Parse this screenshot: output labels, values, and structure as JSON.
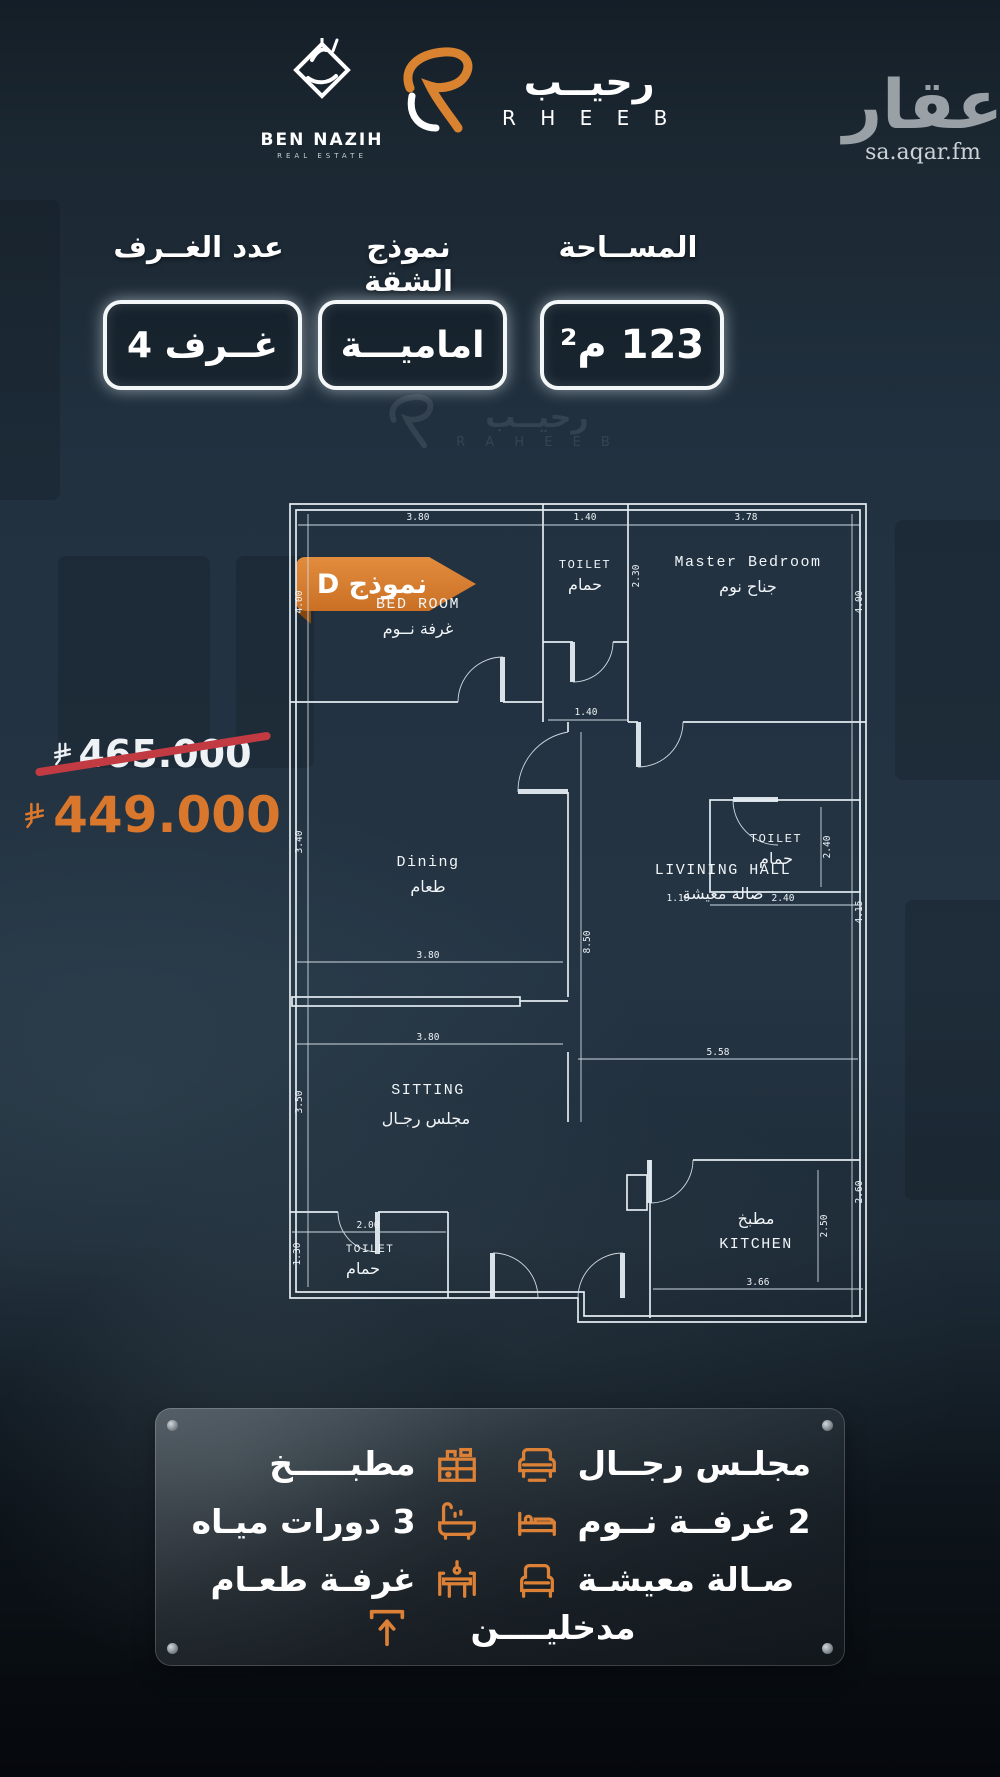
{
  "brand": {
    "ben_nazih": {
      "name": "BEN NAZIH",
      "tagline": "REAL ESTATE"
    },
    "rheeb": {
      "arabic": "رحيــب",
      "latin": "R H E E B"
    },
    "aqar": {
      "arabic": "عقار",
      "domain": "sa.aqar.fm"
    }
  },
  "watermark": {
    "arabic": "رحيــب",
    "latin": "R A H E E B"
  },
  "specs": {
    "area": {
      "label": "المســاحة",
      "value": "123 م²"
    },
    "model": {
      "label": "نموذج الشقة",
      "value": "اماميـــة"
    },
    "rooms": {
      "label": "عدد الغــرف",
      "value": "4 غــرف"
    }
  },
  "badge": {
    "label": "نموذج D"
  },
  "price": {
    "old": "465.000",
    "new": "449.000"
  },
  "floorplan": {
    "rooms": {
      "bedroom": {
        "en": "BED ROOM",
        "ar": "غرفة نــوم"
      },
      "toilet_top": {
        "en": "TOILET",
        "ar": "حمام"
      },
      "master": {
        "en": "Master Bedroom",
        "ar": "جناح نوم"
      },
      "dining": {
        "en": "Dining",
        "ar": "طعام"
      },
      "toilet_mid": {
        "en": "TOILET",
        "ar": "حمام"
      },
      "hall": {
        "en": "LIVINING HALL",
        "ar": "صالة معيشة"
      },
      "sitting": {
        "en": "SITTING",
        "ar": "مجلس رجـال"
      },
      "toilet_bottom": {
        "en": "TOILET",
        "ar": "حمام"
      },
      "kitchen": {
        "en": "KITCHEN",
        "ar": "مطبخ"
      }
    },
    "dims": {
      "top_bedroom": "3.80",
      "top_toilet": "1.40",
      "top_master": "3.78",
      "left_bedroom": "4.00",
      "toilet_top_h": "2.30",
      "right_master": "4.00",
      "corridor": "1.40",
      "toilet_mid_a": "1.18",
      "toilet_mid_b": "2.40",
      "toilet_mid_h": "2.40",
      "left_dining": "3.40",
      "center_vert": "8.50",
      "dining_w": "3.80",
      "sitting_top": "3.80",
      "hall_w": "5.58",
      "right_hall": "4.15",
      "left_sitting": "3.50",
      "toilet_bottom_w": "2.00",
      "left_toilet_bottom": "1.30",
      "kitchen_w": "3.66",
      "kitchen_h": "2.50",
      "right_kitchen": "2.60"
    }
  },
  "legend": {
    "items": [
      {
        "id": "kitchen",
        "label": "مطبـــــخ"
      },
      {
        "id": "majlis",
        "label": "مجلـس رجــال"
      },
      {
        "id": "bathrooms",
        "label": "3 دورات ميـاه"
      },
      {
        "id": "bedrooms",
        "label": "2 غرفــة نــوم"
      },
      {
        "id": "dining",
        "label": "غرفـة طعـام"
      },
      {
        "id": "living",
        "label": "صـالة معيشـة"
      },
      {
        "id": "entrances",
        "label": "مدخليــــن"
      }
    ]
  },
  "colors": {
    "accent": "#DD8136",
    "strike": "#C23A42",
    "blueprint": "#E3EBF1",
    "background": "#1E2C38"
  }
}
